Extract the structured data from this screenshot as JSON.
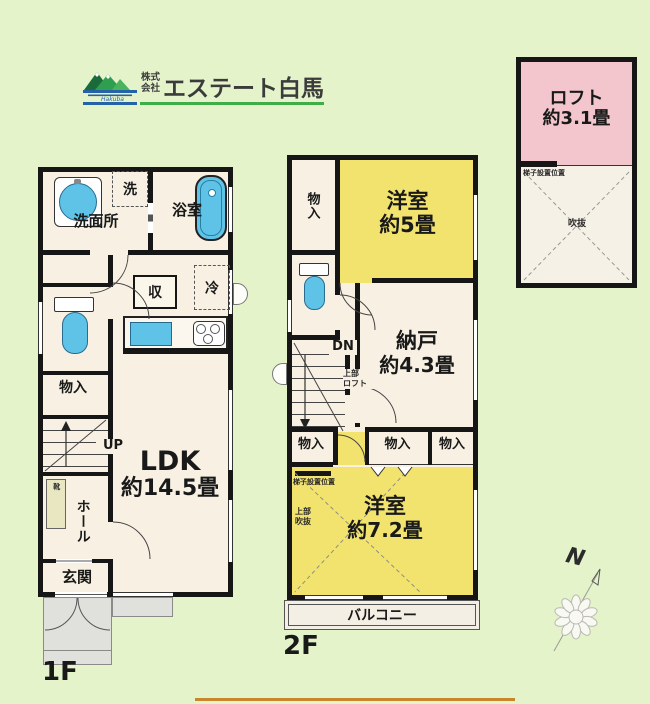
{
  "logo": {
    "prefix": "株式会社",
    "name": "エステート白馬",
    "icon_caption": "Hakuba"
  },
  "floor1": {
    "label": "1F",
    "ldk_name": "LDK",
    "ldk_size": "約14.5畳",
    "washroom": "洗面所",
    "bath": "浴室",
    "washer": "洗",
    "fridge": "冷",
    "pantry": "収",
    "storage": "物入",
    "hall": "ホール",
    "entrance": "玄関",
    "shoe": "靴",
    "stairs": "UP"
  },
  "floor2": {
    "label": "2F",
    "west5_name": "洋室",
    "west5_size": "約5畳",
    "storeroom_name": "納戸",
    "storeroom_size": "約4.3畳",
    "west72_name": "洋室",
    "west72_size": "約7.2畳",
    "balcony": "バルコニー",
    "storage_top": "物入",
    "storage_a": "物入",
    "storage_b": "物入",
    "storage_c": "物入",
    "stairs": "DN",
    "loft_above": "上部\nロフト",
    "ladder_note": "梯子設置位置",
    "void_above": "上部\n吹抜"
  },
  "loft": {
    "name": "ロフト",
    "size": "約3.1畳",
    "ladder_note": "梯子設置位置",
    "void": "吹抜"
  },
  "compass": {
    "n": "N"
  },
  "colors": {
    "background": "#e5f3cb",
    "room_yellow": "#f2e36e",
    "loft_pink": "#f2c6cc",
    "fixture_blue": "#5fc3e8",
    "bottom_line": "#c9872c",
    "logo_green": "#3fae49",
    "logo_blue": "#2563a8"
  }
}
